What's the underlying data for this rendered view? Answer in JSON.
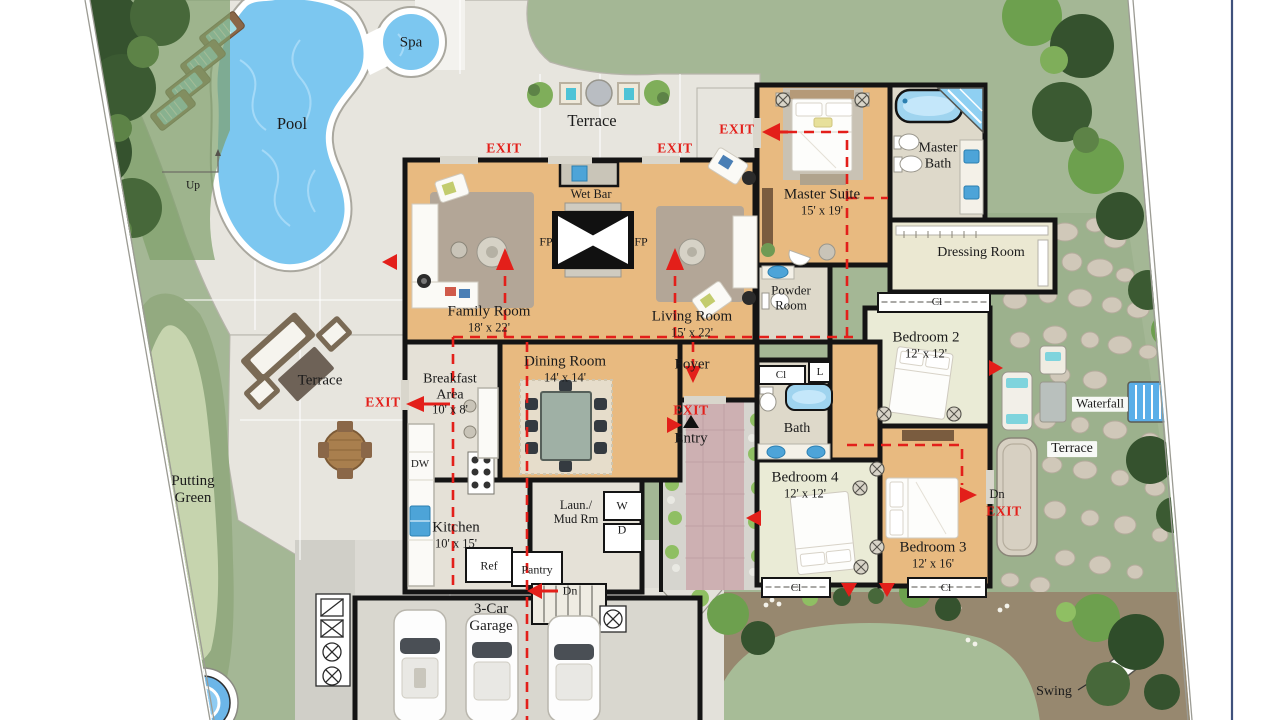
{
  "outdoor": {
    "pool": "Pool",
    "spa": "Spa",
    "up": "Up",
    "terrace": "Terrace",
    "putting_green": "Putting Green",
    "waterfall": "Waterfall",
    "swing": "Swing"
  },
  "nav": {
    "exit": "EXIT",
    "entry": "Entry",
    "dn": "Dn"
  },
  "rooms": {
    "family_room": {
      "name": "Family Room",
      "dims": "18' x 22'"
    },
    "living_room": {
      "name": "Living Room",
      "dims": "15' x 22'"
    },
    "dining_room": {
      "name": "Dining Room",
      "dims": "14' x 14'"
    },
    "master_suite": {
      "name": "Master Suite",
      "dims": "15' x 19'"
    },
    "master_bath": {
      "name": "Master Bath"
    },
    "dressing_room": {
      "name": "Dressing Room"
    },
    "powder_room": {
      "name": "Powder Room"
    },
    "bedroom_2": {
      "name": "Bedroom 2",
      "dims": "12' x 12'"
    },
    "bedroom_3": {
      "name": "Bedroom 3",
      "dims": "12' x 16'"
    },
    "bedroom_4": {
      "name": "Bedroom 4",
      "dims": "12' x 12'"
    },
    "breakfast_area": {
      "name": "Breakfast Area",
      "dims": "10' x 8'"
    },
    "kitchen": {
      "name": "Kitchen",
      "dims": "10' x 15'"
    },
    "foyer": {
      "name": "Foyer"
    },
    "bath": {
      "name": "Bath"
    },
    "laundry": {
      "name": "Laun./ Mud Rm"
    },
    "garage": {
      "name": "3-Car Garage"
    },
    "wet_bar": {
      "name": "Wet Bar"
    }
  },
  "fixtures": {
    "fp": "FP",
    "dw": "DW",
    "ref": "Ref",
    "pantry": "Pantry",
    "washer": "W",
    "dryer": "D",
    "linen": "L",
    "closet": "Cl"
  },
  "colors": {
    "accent_red": "#e31f1a",
    "pool_water": "#7cc7f0",
    "wood_floor": "#e8ba80",
    "lawn_green": "#a4b795",
    "border_blue": "#3f517c"
  }
}
